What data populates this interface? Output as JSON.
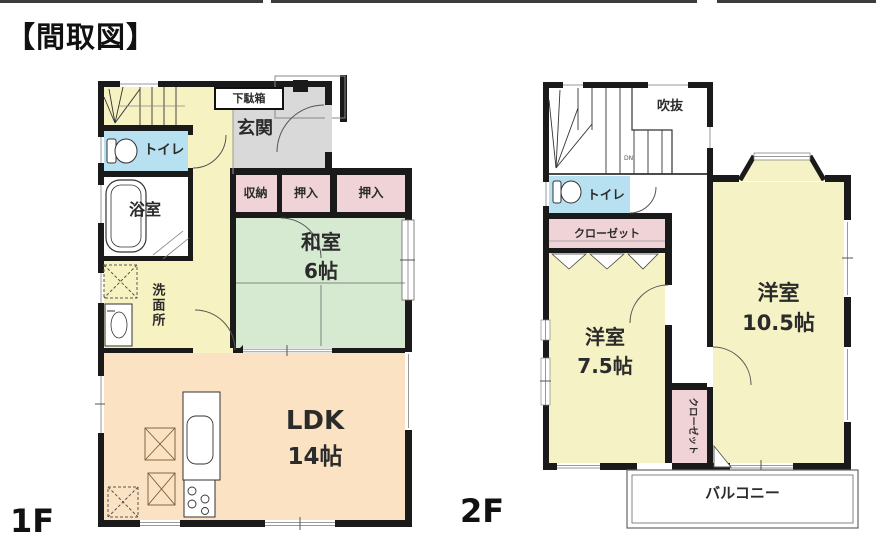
{
  "title": "【間取図】",
  "colors": {
    "wall": "#1a1a1a",
    "hall_yellow_1f": "#f7f2c1",
    "toilet_blue": "#b7e0f0",
    "closet_pink": "#f0d3d6",
    "tatami_green": "#d6ead2",
    "ldk_peach": "#fae2c3",
    "genkan_gray": "#d9d9d9",
    "room_yellow_2f": "#f5f3c5"
  },
  "floor1": {
    "floor_label": "1F",
    "rooms": {
      "getabako": "下駄箱",
      "genkan": "玄関",
      "toilet": "トイレ",
      "bath": "浴室",
      "senmenjo": "洗面所",
      "shuno": "収納",
      "oshiire_a": "押入",
      "oshiire_b": "押入",
      "washitsu": "和室",
      "washitsu_size": "6帖",
      "ldk": "LDK",
      "ldk_size": "14帖"
    }
  },
  "floor2": {
    "floor_label": "2F",
    "rooms": {
      "fukinuke": "吹抜",
      "dn": "DN",
      "toilet": "トイレ",
      "closet_main": "クローゼット",
      "yoshitsu_a": "洋室",
      "yoshitsu_a_size": "7.5帖",
      "yoshitsu_b": "洋室",
      "yoshitsu_b_size": "10.5帖",
      "closet_side": "クローゼット",
      "balcony": "バルコニー"
    }
  }
}
